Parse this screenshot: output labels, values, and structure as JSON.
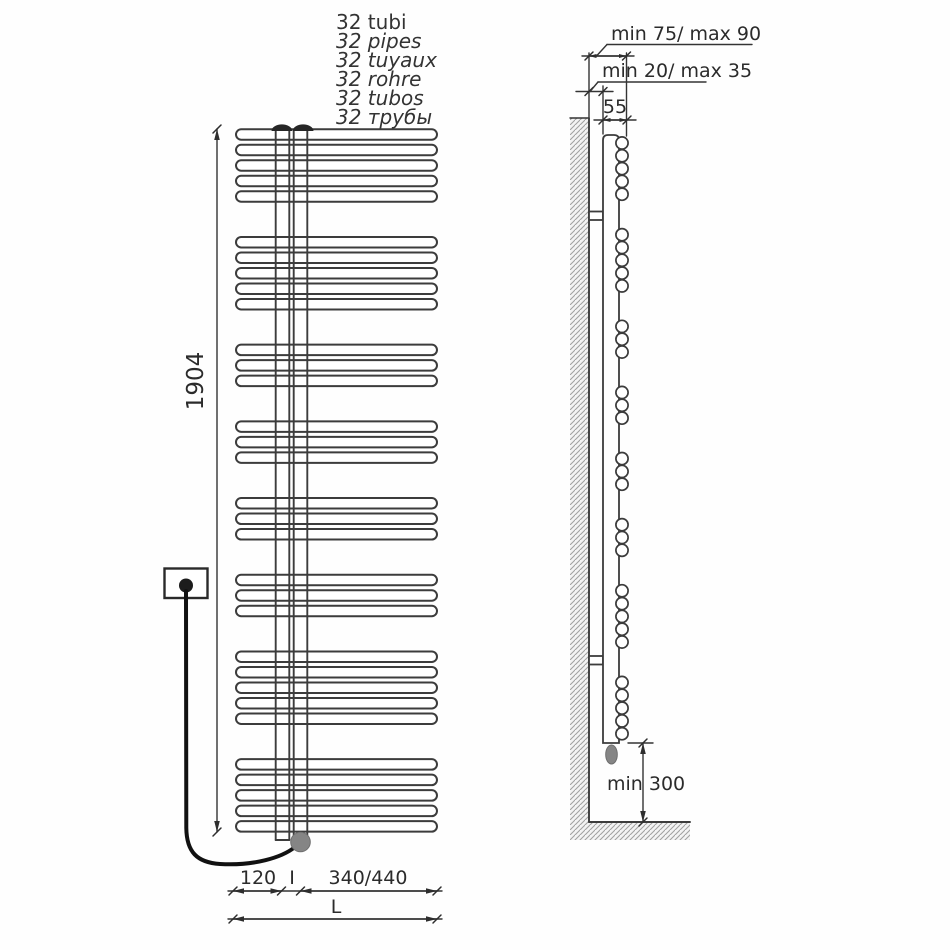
{
  "title_block": {
    "lines": [
      {
        "text": "32 tubi"
      },
      {
        "text": "32 pipes"
      },
      {
        "text": "32 tuyaux"
      },
      {
        "text": "32 rohre"
      },
      {
        "text": "32 tubos"
      },
      {
        "text": "32 трубы"
      }
    ]
  },
  "front_view": {
    "pipe_count": 32,
    "pipe_groups": [
      5,
      5,
      3,
      3,
      3,
      3,
      5,
      5
    ],
    "height_label": "1904",
    "dim_left_label": "120",
    "dim_interaxis_label": "I",
    "dim_right_label": "340/440",
    "total_width_label": "L"
  },
  "side_view": {
    "pipe_groups": [
      5,
      5,
      3,
      3,
      3,
      3,
      5,
      5
    ],
    "wall_distance_upper_label": "min 75/ max 90",
    "wall_distance_lower_label": "min 20/ max 35",
    "depth_label": "55",
    "floor_clearance_label": "min 300"
  },
  "colors": {
    "line": "#3c3c3c",
    "text": "#2b2b2b",
    "hatch": "#9f9f9f",
    "element_fill": "#858585",
    "background": "#ffffff"
  }
}
